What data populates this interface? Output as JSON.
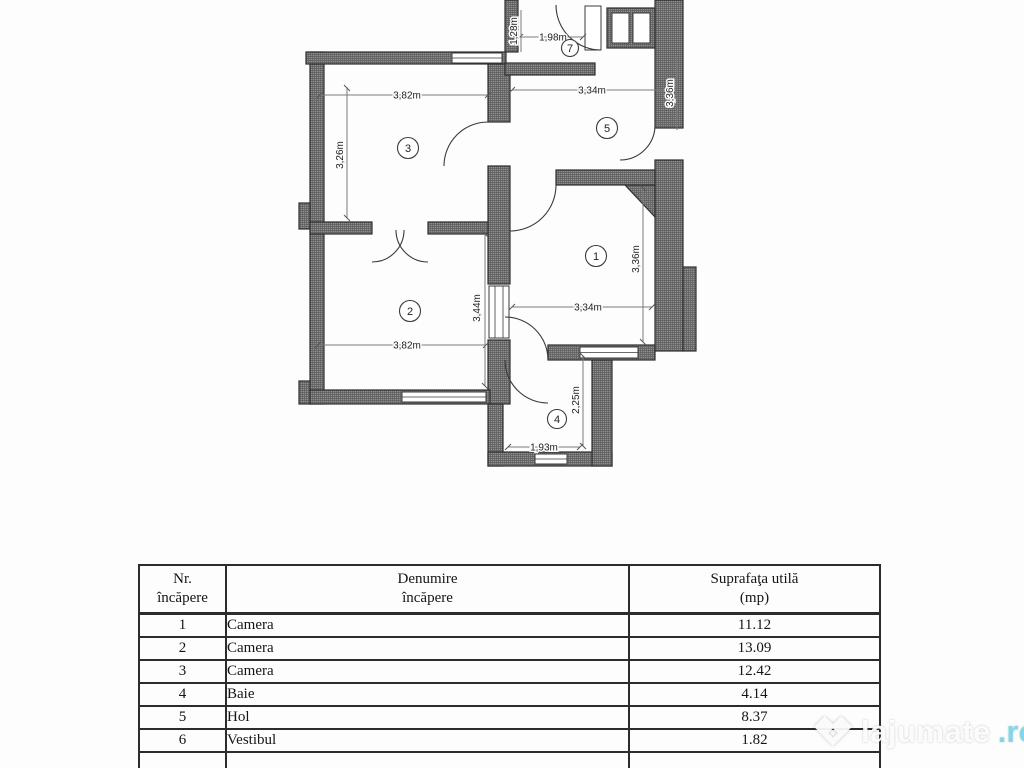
{
  "plan": {
    "wall_color": "#919191",
    "line_color": "#3a3a3a",
    "room_labels": {
      "c1": "1",
      "c2": "2",
      "c3": "3",
      "c4": "4",
      "c5": "5",
      "c7": "7"
    },
    "dimensions": {
      "room3_w": "3,82m",
      "room3_h": "3,26m",
      "room2_w": "3,82m",
      "room2_h": "3,44m",
      "room5_w": "3,34m",
      "room5_h": "3,36m",
      "room1_w": "3,34m",
      "room1_h": "3,36m",
      "room4_w": "1,93m",
      "room4_h": "2,25m",
      "room7_w": "1,98m",
      "room7_h": "1,28m"
    }
  },
  "table": {
    "headers": {
      "nr_line1": "Nr.",
      "nr_line2": "încăpere",
      "den_line1": "Denumire",
      "den_line2": "încăpere",
      "sup_line1": "Suprafaţa utilă",
      "sup_line2": "(mp)"
    },
    "rows": [
      {
        "nr": "1",
        "name": "Camera",
        "area": "11.12"
      },
      {
        "nr": "2",
        "name": "Camera",
        "area": "13.09"
      },
      {
        "nr": "3",
        "name": "Camera",
        "area": "12.42"
      },
      {
        "nr": "4",
        "name": "Baie",
        "area": "4.14"
      },
      {
        "nr": "5",
        "name": "Hol",
        "area": "8.37"
      },
      {
        "nr": "6",
        "name": "Vestibul",
        "area": "1.82"
      }
    ]
  },
  "watermark": {
    "text": "lajumate",
    "tld": ".ro"
  }
}
